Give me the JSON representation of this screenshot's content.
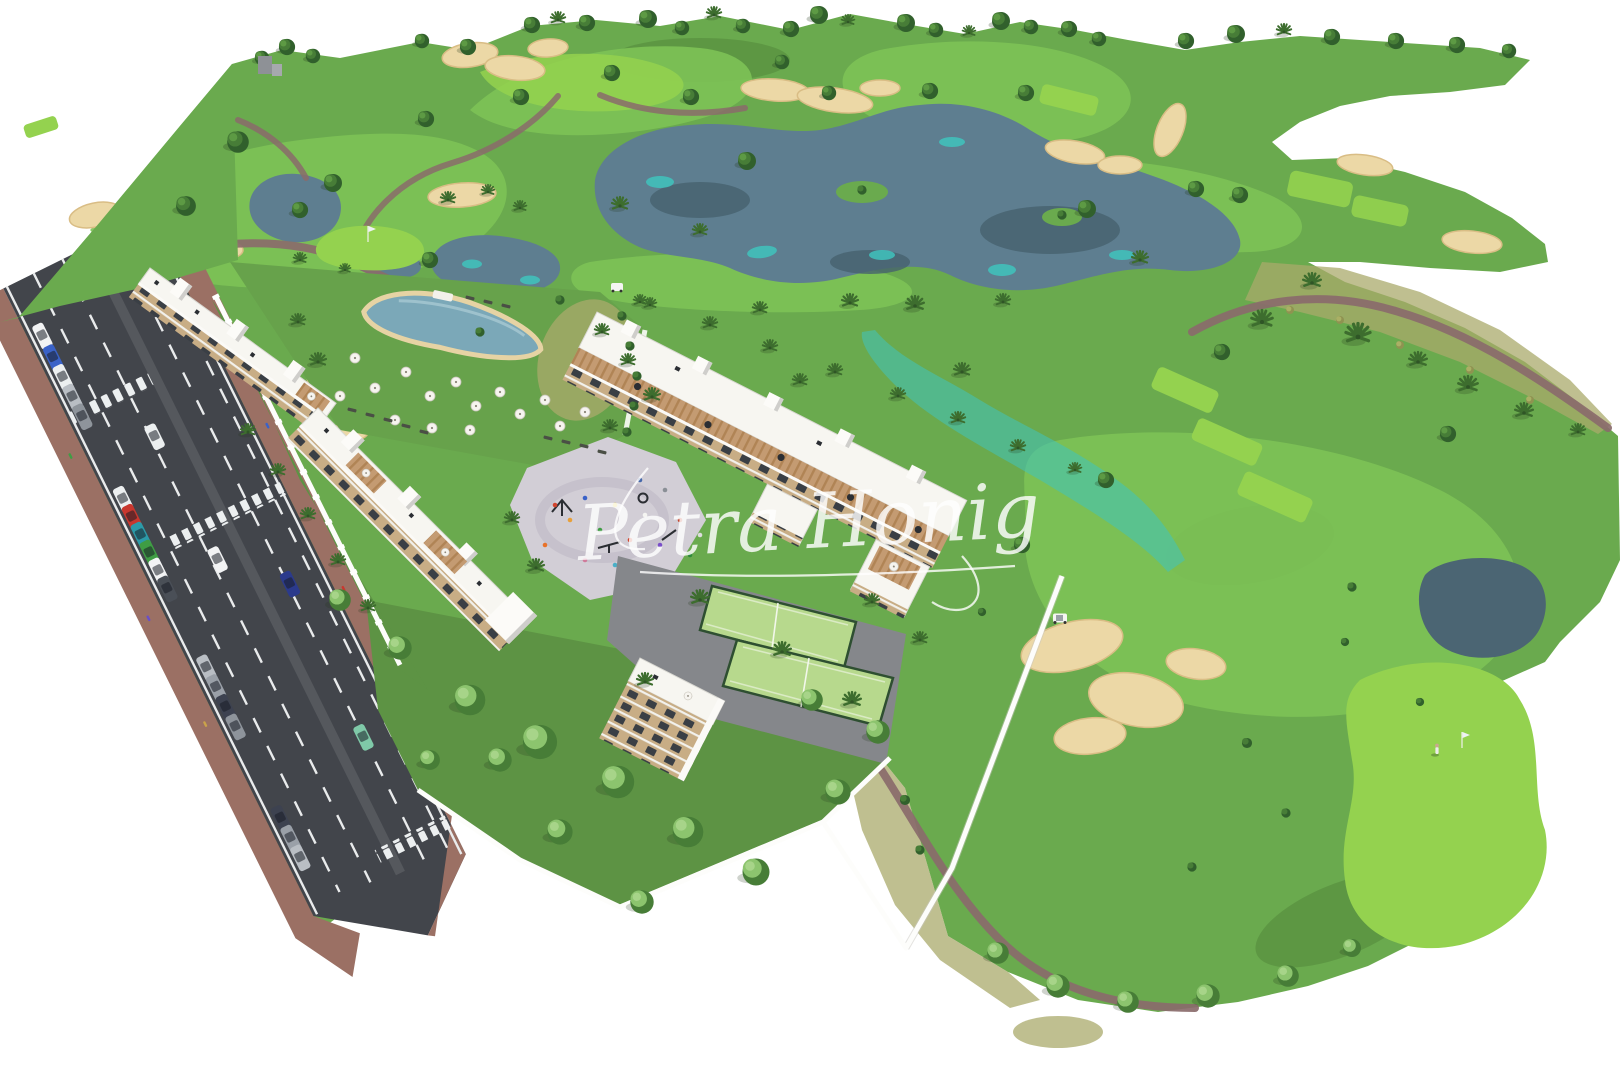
{
  "image": {
    "type": "aerial-3d-render",
    "description": "Aerial 3D rendering of a new-build apartment complex beside a golf course with lakes, sand bunkers, pool, padel courts, playground and an access road with parked cars",
    "watermark": {
      "text": "Petra Honig",
      "underline": true
    }
  },
  "palette": {
    "terrain": "#6aaa4e",
    "fairway": "#7dc257",
    "vivid": "#94d24f",
    "rough": "#4d8038",
    "scrub": "#a9a96b",
    "garden": "#5d9344",
    "lawn": "#67a24b",
    "lake": "#5e7e90",
    "lakedeep": "#46616e",
    "lakedark": "#4b6573",
    "teal": "#3fc3bd",
    "sand": "#ecd8a6",
    "sandrim": "#d9bd85",
    "path": "#8a6b6b",
    "asphalt": "#42454b",
    "asphalt2": "#55585d",
    "brick": "#9b7064",
    "plaza": "#d2ced6",
    "paving": "#85878b",
    "bwhite": "#f7f6f1",
    "roofedge": "#d9d8d2",
    "facade": "#c8ad85",
    "window": "#3a3f45",
    "terrace": "#c49b72",
    "wallwhite": "#fdfdfb",
    "pool": "#7ba8b8",
    "court": "#b7d98d",
    "fence": "#2e4f31",
    "treedark": "#31602c",
    "treemid": "#477d37",
    "treelight": "#5d9a44",
    "palm": "#3d6d2e",
    "bushlight": "#8cc46e",
    "furn": "#2b2e33",
    "watermark": "#ffffff"
  },
  "scene": {
    "features": [
      "golf course",
      "fairways",
      "putting greens",
      "tee boxes",
      "lakes",
      "stream",
      "sand bunkers",
      "cart paths",
      "palm trees",
      "round trees",
      "bushes",
      "apartment buildings",
      "rooftop terraces",
      "pergolas",
      "stair towers",
      "lagoon swimming pool",
      "parasols",
      "sun loungers",
      "playground",
      "padel courts",
      "private gardens",
      "perimeter walls",
      "access road",
      "zebra crossings",
      "parked cars",
      "moving cars",
      "pedestrians",
      "golf flag",
      "golfer",
      "golf carts"
    ]
  }
}
